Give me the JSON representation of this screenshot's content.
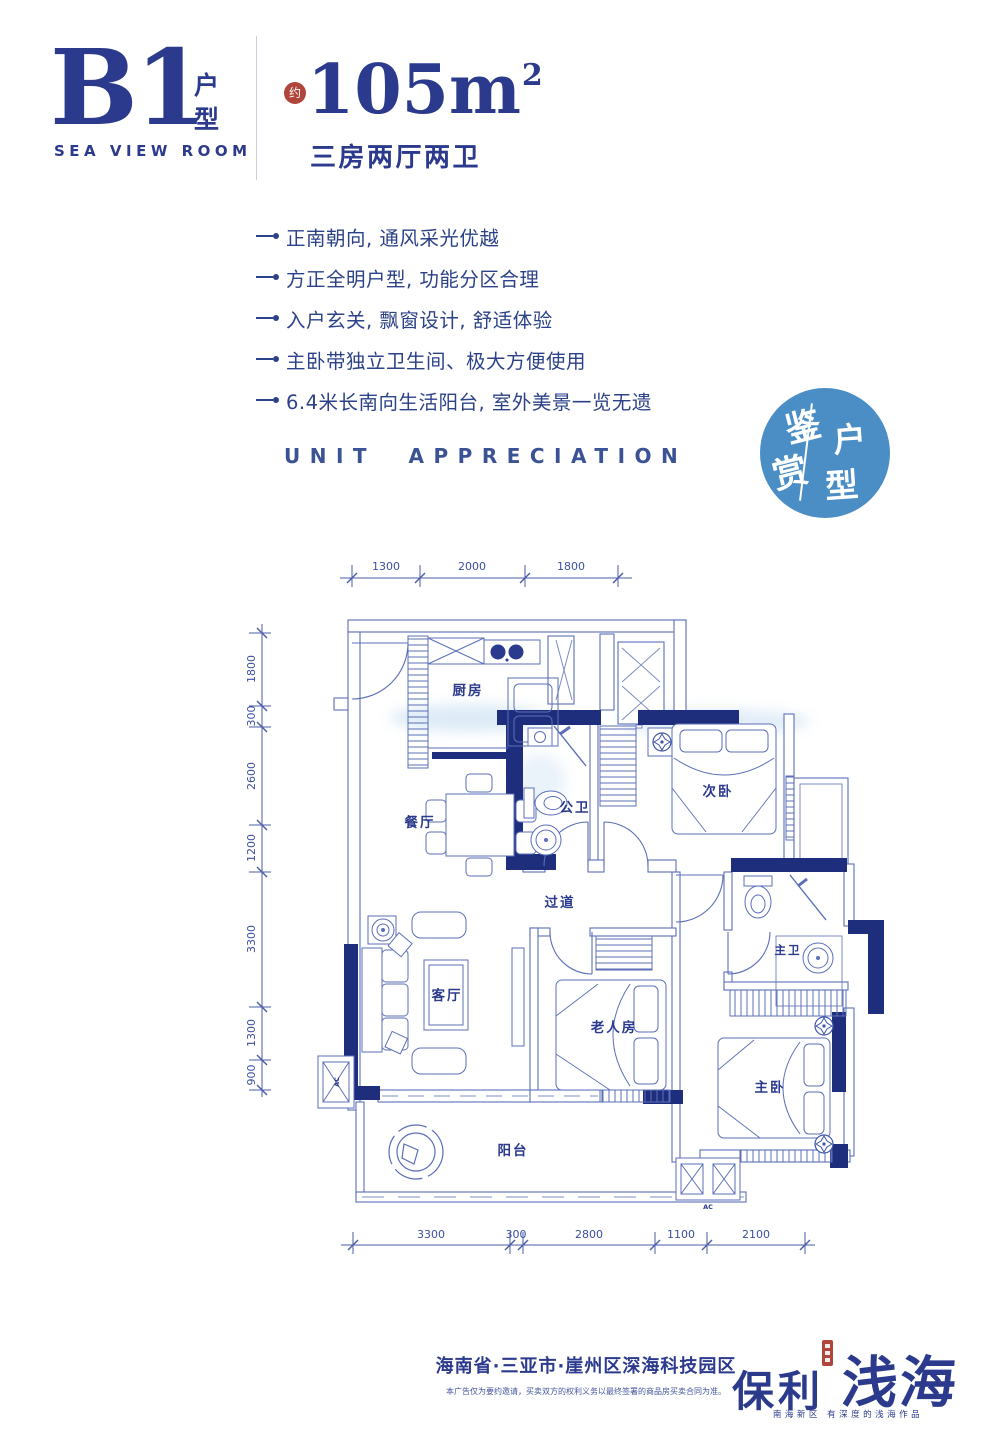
{
  "colors": {
    "navy": "#2b3a8c",
    "plan_navy": "#1f2d7d",
    "plan_line": "#5b6fb8",
    "badge_blue": "#4a8ec5",
    "red": "#b0453c"
  },
  "header": {
    "unit_code": "B1",
    "unit_label_1": "户",
    "unit_label_2": "型",
    "subtitle": "SEA VIEW ROOM",
    "approx": "约",
    "area": "105m",
    "area_sup": "2",
    "spec": "三房两厅两卫"
  },
  "features": [
    "正南朝向, 通风采光优越",
    "方正全明户型, 功能分区合理",
    "入户玄关, 飘窗设计, 舒适体验",
    "主卧带独立卫生间、极大方便使用",
    "6.4米长南向生活阳台, 室外美景一览无遗"
  ],
  "section_title": "UNIT APPRECIATION",
  "badge": {
    "c1": "鉴",
    "c2": "赏",
    "c3": "户",
    "c4": "型"
  },
  "floorplan": {
    "rooms": {
      "kitchen": "厨房",
      "dining": "餐厅",
      "public_bath": "公卫",
      "second_bedroom": "次卧",
      "hallway": "过道",
      "living": "客厅",
      "elder_room": "老人房",
      "master_bath": "主卫",
      "master_bedroom": "主卧",
      "balcony": "阳台"
    },
    "ac": "AC",
    "dims_top": [
      "1300",
      "2000",
      "1800"
    ],
    "dims_left": [
      "1800",
      "300",
      "2600",
      "1200",
      "3300",
      "1300",
      "900"
    ],
    "dims_bottom": [
      "3300",
      "300",
      "2800",
      "1100",
      "2100"
    ]
  },
  "footer": {
    "address": "海南省·三亚市·崖州区深海科技园区",
    "disclaimer": "本广告仅为要约邀请，买卖双方的权利义务以最终签署的商品房买卖合同为准。",
    "brand_left": "保利",
    "brand_right": "浅海",
    "tagline": "南海新区 有深度的浅海作品"
  }
}
